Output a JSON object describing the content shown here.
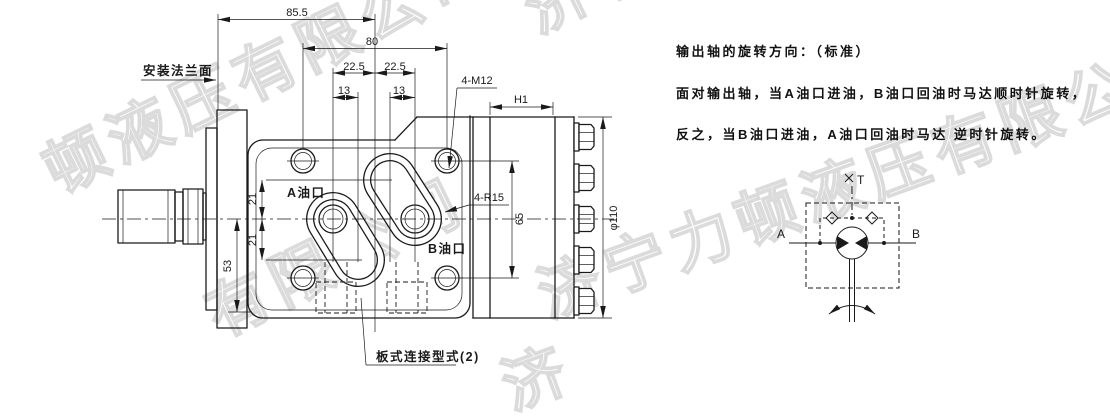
{
  "colors": {
    "line": "#1a1a1a",
    "watermark": "#dbdbdb",
    "background": "#ffffff"
  },
  "watermarks": {
    "wm1": "顿液压有限公司",
    "wm2": "济宁",
    "wm3": "济宁力顿液压有限公司",
    "wm4": "有限公司",
    "wm5": "济"
  },
  "notes": {
    "line1": "输出轴的旋转方向：（标准）",
    "line2": "面对输出轴，当A油口进油，B油口回油时马达顺时针旋转，",
    "line3": "反之，当B油口进油，A油口回油时马达 逆时针旋转。"
  },
  "labels": {
    "mounting_flange": "安装法兰面",
    "port_a": "A油口",
    "port_b": "B油口",
    "plate_connection": "板式连接型式(2)"
  },
  "dimensions": {
    "d85_5": "85.5",
    "d80": "80",
    "d22_5_left": "22.5",
    "d22_5_right": "22.5",
    "d13_left": "13",
    "d13_right": "13",
    "d21_upper": "21",
    "d21_lower": "21",
    "d53": "53",
    "d65": "65",
    "h1": "H1",
    "dia110": "φ110",
    "bolt_thread": "4-M12",
    "corner_radius": "4-R15"
  },
  "schematic": {
    "drain": "T",
    "port_a": "A",
    "port_b": "B"
  }
}
